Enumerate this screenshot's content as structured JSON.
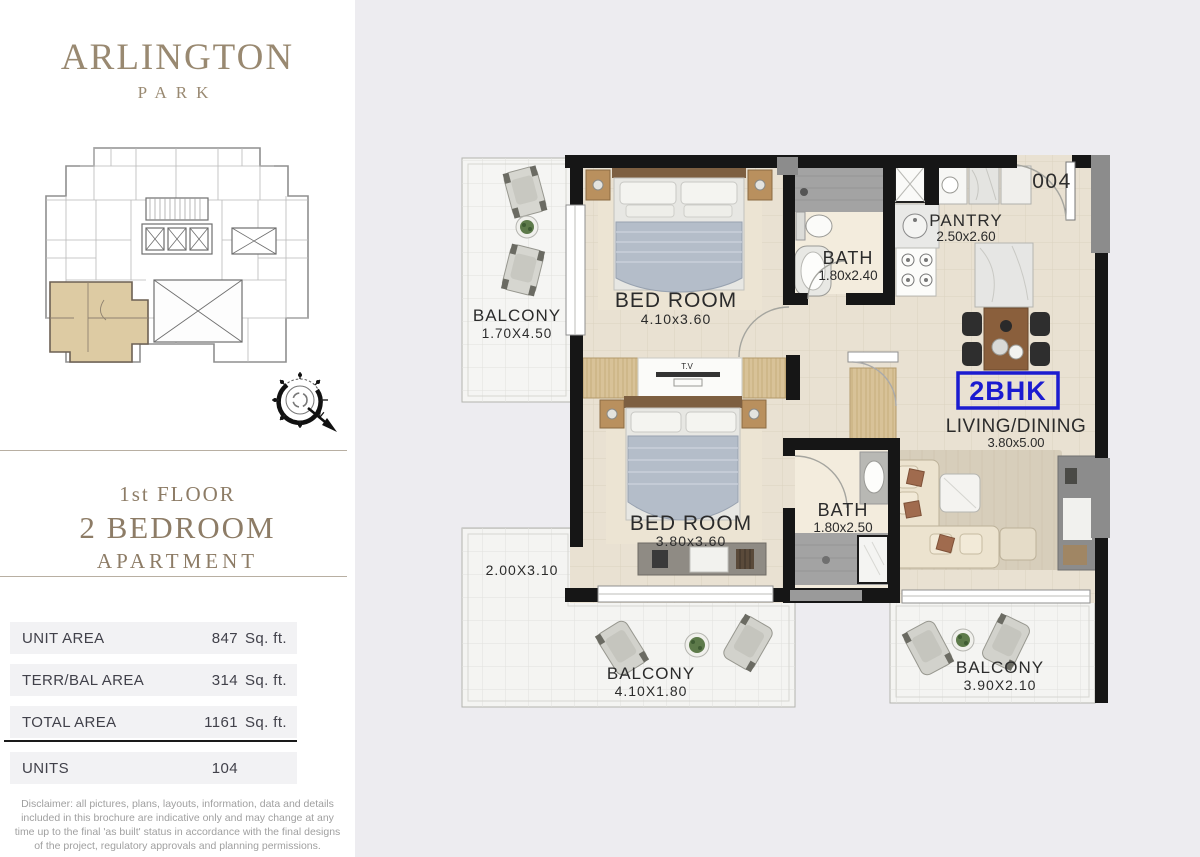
{
  "brand": {
    "name": "ARLINGTON",
    "sub": "PARK"
  },
  "floor_title": {
    "line1": "1st FLOOR",
    "line2": "2 BEDROOM",
    "line3": "APARTMENT"
  },
  "area_table": {
    "rows": [
      {
        "label": "UNIT AREA",
        "value": "847",
        "unit": "Sq. ft."
      },
      {
        "label": "TERR/BAL AREA",
        "value": "314",
        "unit": "Sq. ft."
      },
      {
        "label": "TOTAL AREA",
        "value": "1161",
        "unit": "Sq. ft."
      },
      {
        "label": "UNITS",
        "value": "104",
        "unit": ""
      }
    ]
  },
  "disclaimer": "Disclaimer:  all pictures, plans, layouts, information, data and details included in this brochure are indicative only and may change at any time up to the final 'as built' status in accordance with the final designs of the project, regulatory approvals and planning permissions.",
  "plan": {
    "unit_number": "004",
    "unit_type": "2BHK",
    "tv_label": "T.V",
    "compass_north": "N",
    "rooms": {
      "balcony1": {
        "name": "BALCONY",
        "dim": "1.70X4.50"
      },
      "bedroom1": {
        "name": "BED ROOM",
        "dim": "4.10x3.60"
      },
      "bath1": {
        "name": "BATH",
        "dim": "1.80x2.40"
      },
      "pantry": {
        "name": "PANTRY",
        "dim": "2.50x2.60"
      },
      "living": {
        "name": "LIVING/DINING",
        "dim": "3.80x5.00"
      },
      "bedroom2": {
        "name": "BED ROOM",
        "dim": "3.80x3.60"
      },
      "bath2": {
        "name": "BATH",
        "dim": "1.80x2.50"
      },
      "terrace": {
        "dim": "2.00X3.10"
      },
      "balcony_bottom": {
        "name": "BALCONY",
        "dim": "4.10X1.80"
      },
      "balcony_right": {
        "name": "BALCONY",
        "dim": "3.90X2.10"
      }
    }
  },
  "colors": {
    "accent_blue": "#1b1bd0",
    "brand_taupe": "#97876f",
    "wall": "#161616"
  }
}
